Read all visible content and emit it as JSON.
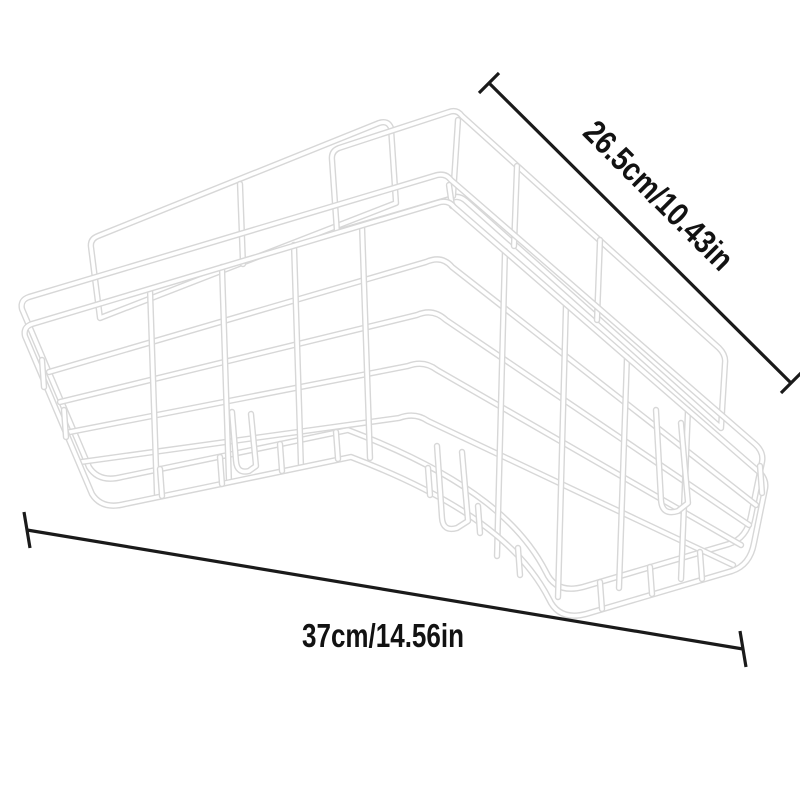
{
  "page": {
    "background": "#ffffff"
  },
  "figure": {
    "subject": "white-corner-wire-shelf-rack",
    "wire_color": "#ffffff",
    "wire_outline_color": "#d7d7d7"
  },
  "dimensions": {
    "line_color": "#1a1a1a",
    "text_color": "#121212",
    "diagonal": {
      "label": "26.5cm/10.43in"
    },
    "horizontal": {
      "label": "37cm/14.56in"
    }
  }
}
